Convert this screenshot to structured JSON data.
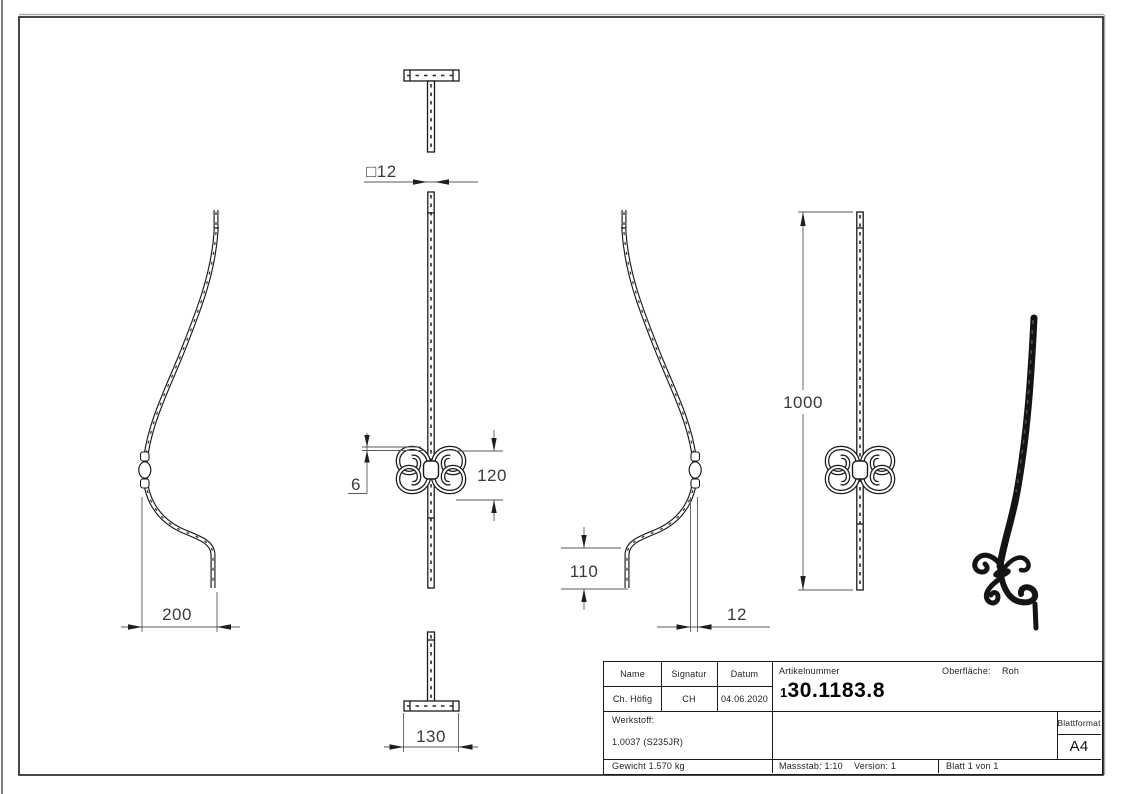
{
  "drawing": {
    "dims": {
      "square": "□12",
      "ornament_height": "120",
      "scroll_thickness": "6",
      "depth": "200",
      "leg_height": "110",
      "thickness": "12",
      "total_height": "1000",
      "base_width": "130"
    },
    "title_block": {
      "name_label": "Name",
      "signatur_label": "Signatur",
      "datum_label": "Datum",
      "name_value": "Ch. Höfig",
      "signatur_value": "CH",
      "datum_value": "04.06.2020",
      "artikelnummer_label": "Artikelnummer",
      "artikelnummer_prefix": "1",
      "artikelnummer_value": "30.1183.8",
      "oberflaeche_label": "Oberfläche:",
      "oberflaeche_value": "Roh",
      "werkstoff_label": "Werkstoff:",
      "werkstoff_value": "1.0037 (S235JR)",
      "blattformat_label": "Blattformat",
      "blattformat_value": "A4",
      "gewicht_value": "Gewicht 1.570 kg",
      "massstab_value": "Massstab: 1:10",
      "version_value": "Version: 1",
      "blatt_value": "Blatt 1 von 1"
    }
  }
}
